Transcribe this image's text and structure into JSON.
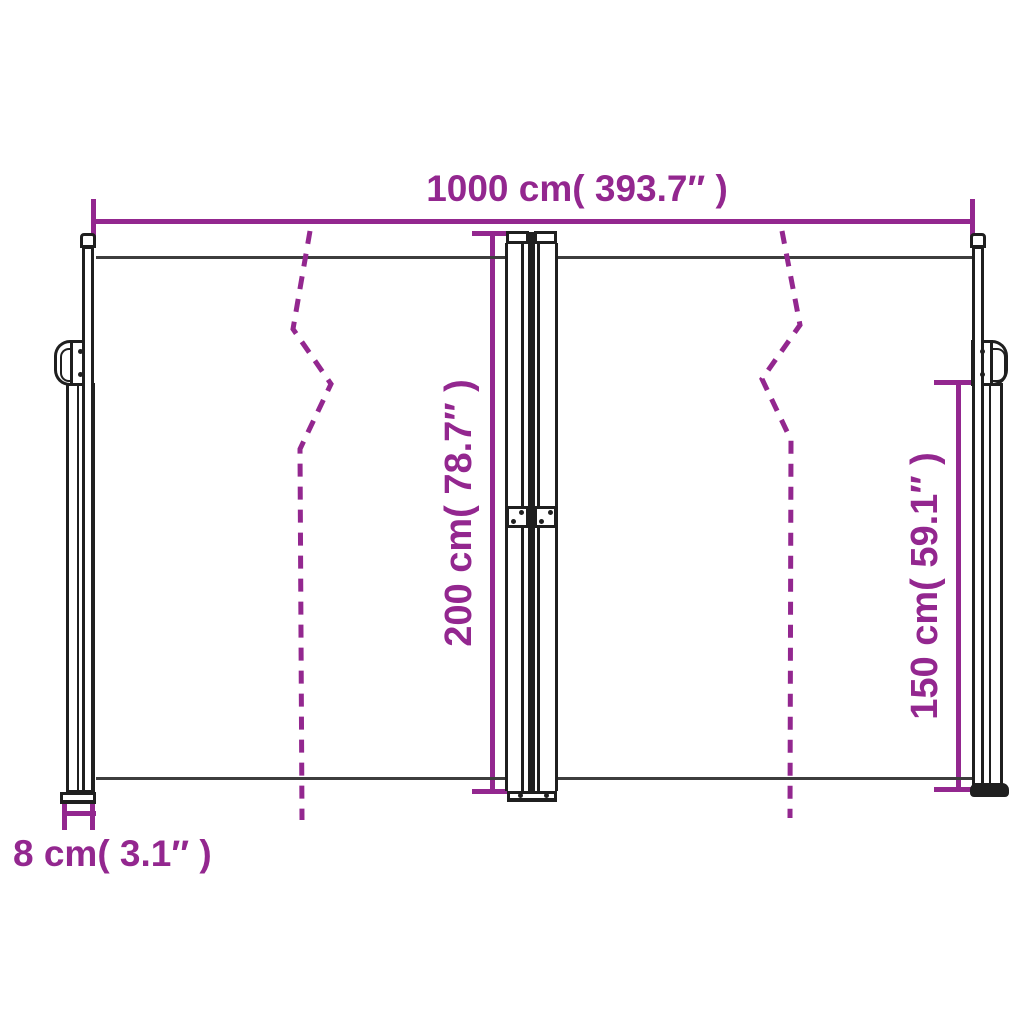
{
  "labels": {
    "total_width": "1000 cm( 393.7″ )",
    "total_height": "200 cm( 78.7″ )",
    "side_height": "150 cm( 59.1″ )",
    "pole_width": "8 cm( 3.1″ )"
  },
  "measurements": {
    "total_width": {
      "cm": 1000,
      "inches": 393.7
    },
    "total_height": {
      "cm": 200,
      "inches": 78.7
    },
    "side_height": {
      "cm": 150,
      "inches": 59.1
    },
    "pole_width": {
      "cm": 8,
      "inches": 3.1
    }
  },
  "colors": {
    "dimension_purple": "#93278F",
    "drawing_dark": "#3D3D3D",
    "drawing_black": "#1F1F1F",
    "background": "#FFFFFF"
  }
}
